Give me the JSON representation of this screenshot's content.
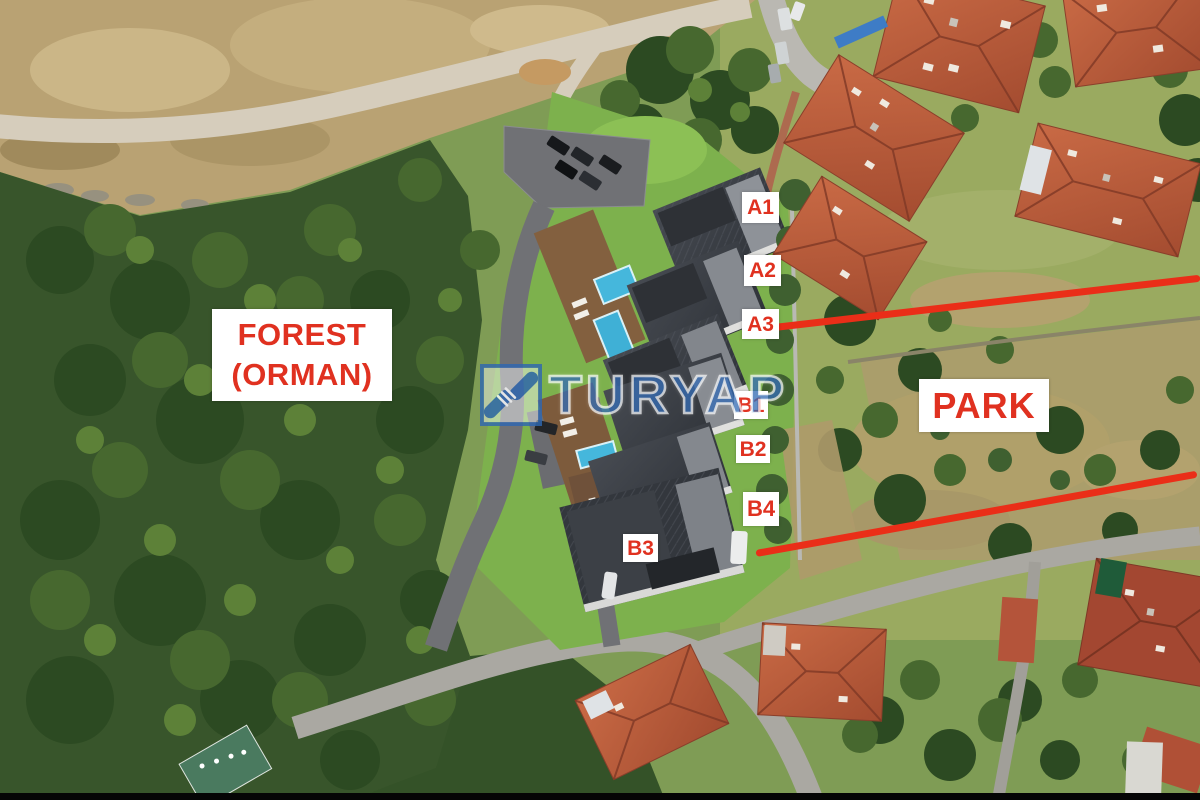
{
  "scene": {
    "type": "aerial-drone-photo",
    "description": "Aerial view of a modern villa development bordered by forest and park, with unit annotations"
  },
  "area_labels": {
    "forest": {
      "line1": "FOREST",
      "line2": "(ORMAN)"
    },
    "park": {
      "text": "PARK"
    }
  },
  "unit_labels": [
    {
      "text": "A1"
    },
    {
      "text": "A2"
    },
    {
      "text": "A3"
    },
    {
      "text": "B1"
    },
    {
      "text": "B2"
    },
    {
      "text": "B4"
    },
    {
      "text": "B3"
    }
  ],
  "boundary_lines": [
    {
      "name": "upper boundary line",
      "color": "#ea2e18"
    },
    {
      "name": "lower boundary line",
      "color": "#ea2e18"
    }
  ],
  "watermark": {
    "brand": "TURYAP",
    "icon": "handshake"
  },
  "colors": {
    "annotation_red": "#e03120",
    "label_background": "#ffffff",
    "watermark_blue": "#2862ae"
  }
}
